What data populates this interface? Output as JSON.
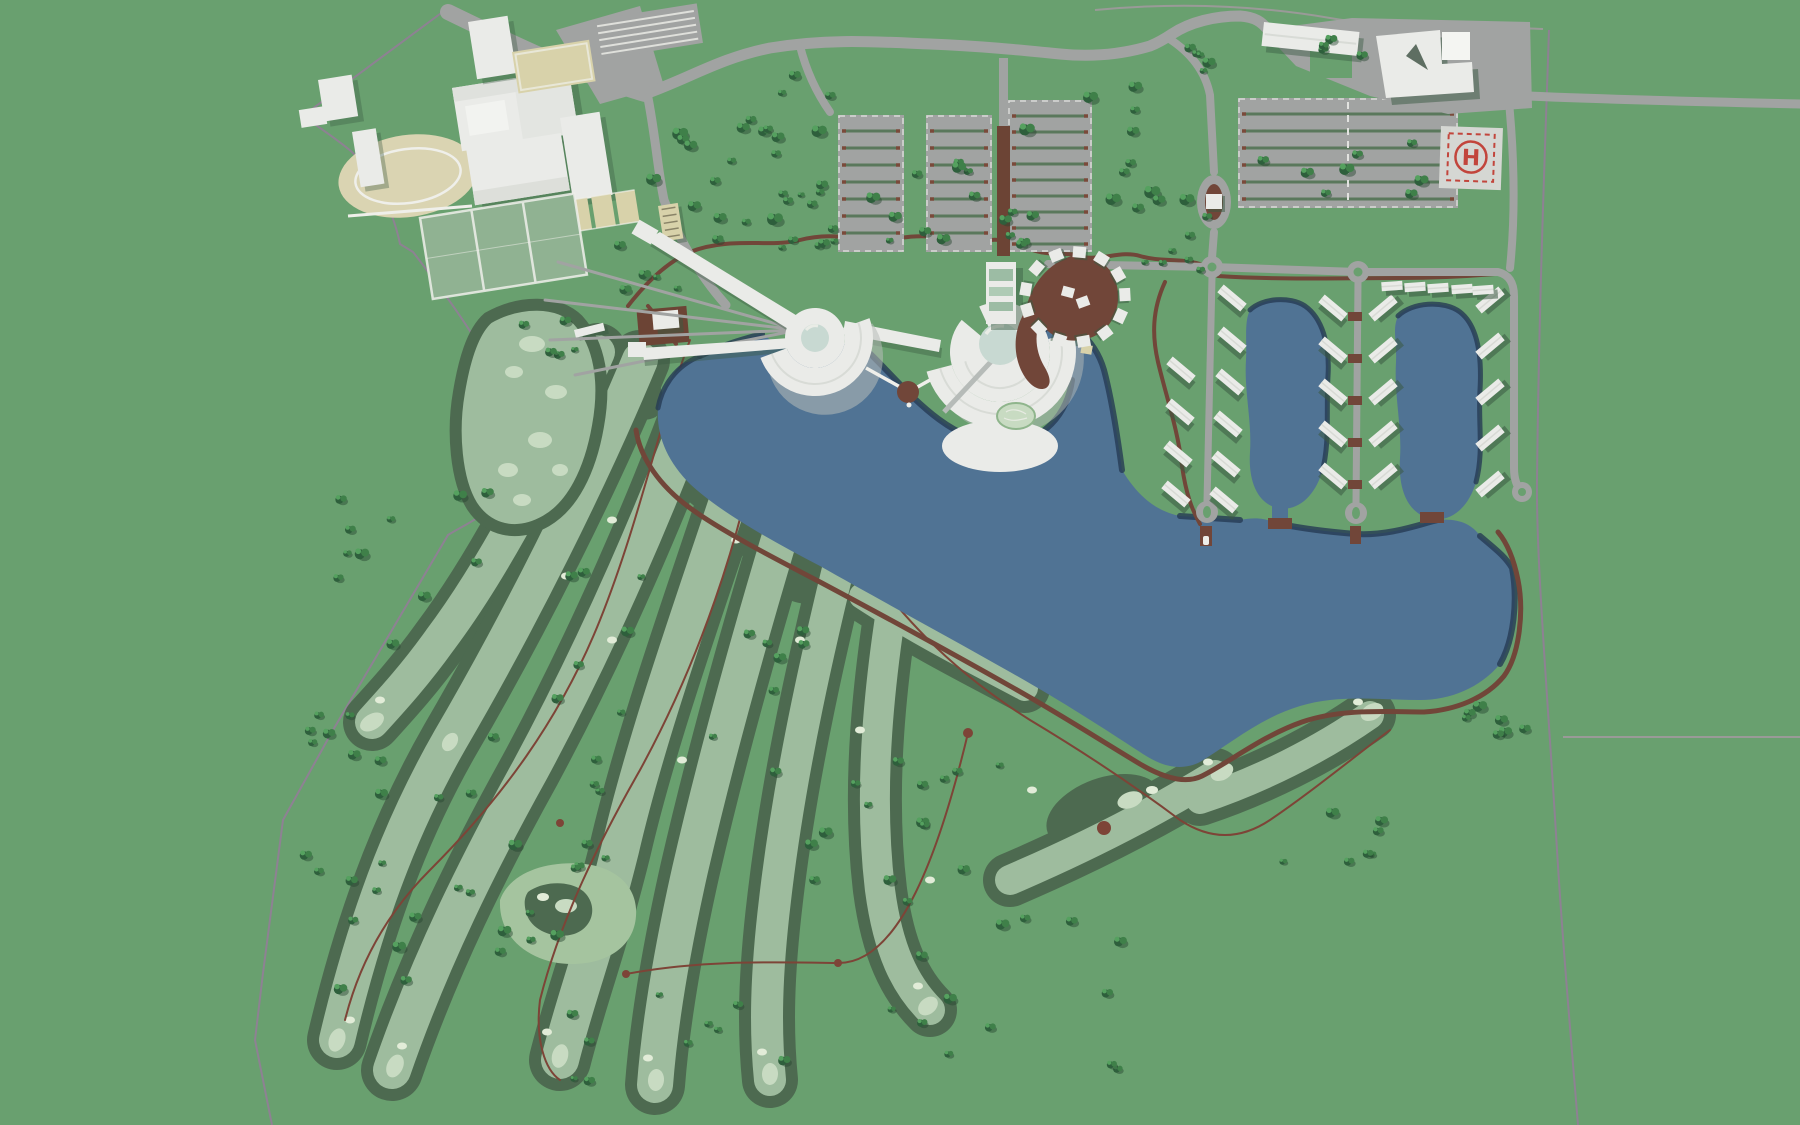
{
  "scene": {
    "title": "Lakeside golf and sports resort - aerial masterplan render",
    "view": "top-down"
  },
  "helipad": {
    "label": "H"
  },
  "palette": {
    "grass": "#69A06F",
    "fairway": "#9EBC9E",
    "fairway_light": "#C8DBC2",
    "bunker": "#E2ECD8",
    "practice": "#A5C49F",
    "rough": "#4D6A50",
    "water": "#507394",
    "water_shadow": "#253B54",
    "road": "#A1A3A2",
    "trail": "#714639",
    "cartpath": "#7D4437",
    "boardwalk": "#6C4435",
    "building": "#EAEBE8",
    "building_edge": "#D8DBD6",
    "building_shadow": "#B6BBB8",
    "cast": "#3A5A42",
    "dome": "#C8D9D2",
    "track": "#DAD4B2",
    "pitch": "#90B292",
    "court": "#D8D2AA",
    "hedge": "#5A785C",
    "hedge_tip": "#7A4A3A",
    "helipad_pad": "#D5D7D3",
    "red": "#C2453C",
    "boundary": "#8E8193",
    "boundary2": "#9A9A98",
    "tree_dark": "#2E5F3C",
    "tree_mid": "#3F8049",
    "tree_light": "#55A15F",
    "tree_shadow": "#26452F"
  },
  "features": {
    "sports_complex": [
      "athletics-track",
      "sports-halls",
      "indoor-arena",
      "outdoor-pitches",
      "tennis-courts",
      "grandstand",
      "clubhouse"
    ],
    "parking_lots": 4,
    "resort_core": [
      "west-rotunda",
      "east-rotunda",
      "link-wing",
      "gatehouse",
      "boardwalk",
      "lake-pier",
      "garden-island"
    ],
    "cottage_spiral_count": 13,
    "villa_count": 30,
    "lagoon_count": 3,
    "service_area": [
      "warehouse",
      "maintenance-hall",
      "helipad"
    ],
    "golf": {
      "fairways": 11,
      "driving_range": true,
      "practice_green": true
    },
    "water_bodies": [
      "main-lake",
      "lagoon-1",
      "lagoon-2",
      "lagoon-3"
    ]
  }
}
